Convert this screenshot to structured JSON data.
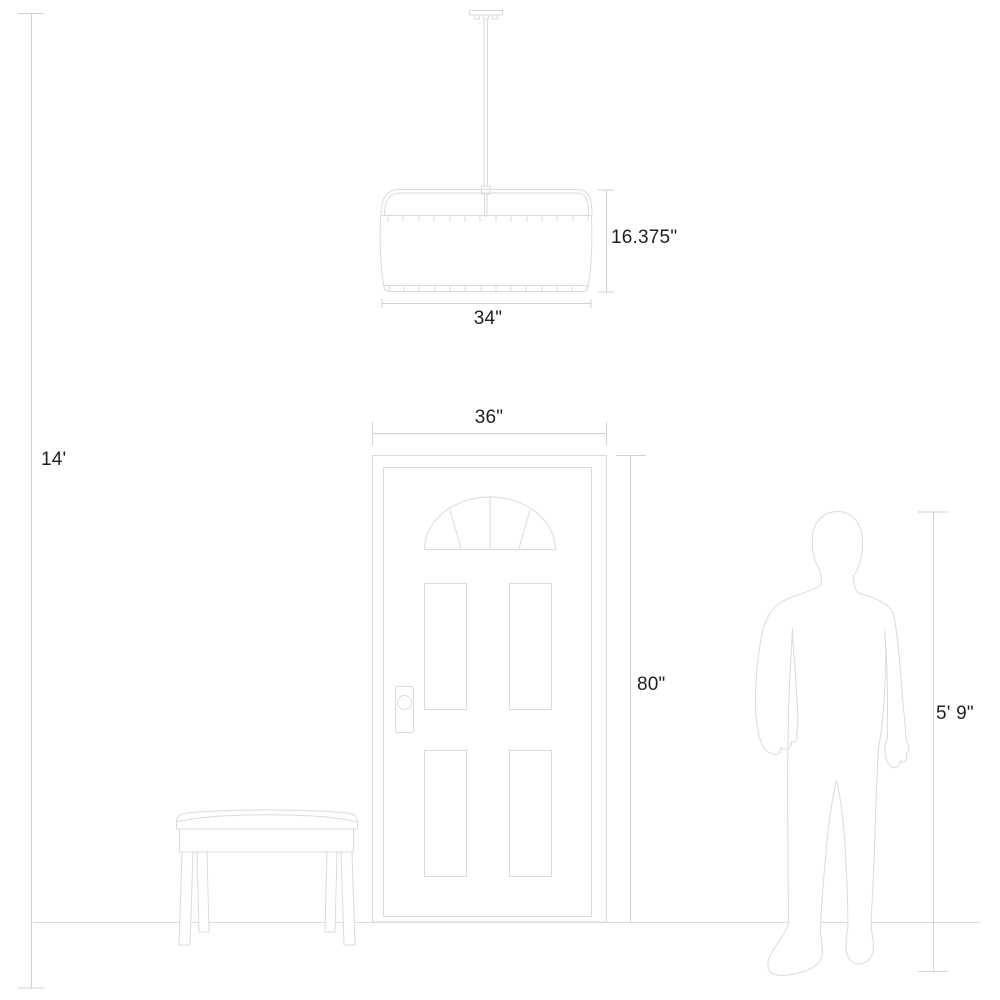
{
  "diagram": {
    "kind": "product-dimension-drawing",
    "background_color": "#ffffff",
    "drawing_line_color": "#d9dbdd",
    "dimension_line_color": "#cfd2d4",
    "text_color": "#1d1f21",
    "labels": {
      "ceiling_height": "14'",
      "fixture_height": "16.375\"",
      "fixture_width": "34\"",
      "door_width": "36\"",
      "door_height": "80\"",
      "person_height": "5' 9\""
    },
    "figures": {
      "fixture": "pendant-light",
      "door": "four-panel-door-with-fanlight",
      "bench": "bench",
      "person": "human-silhouette",
      "floor": "floor-line"
    }
  }
}
